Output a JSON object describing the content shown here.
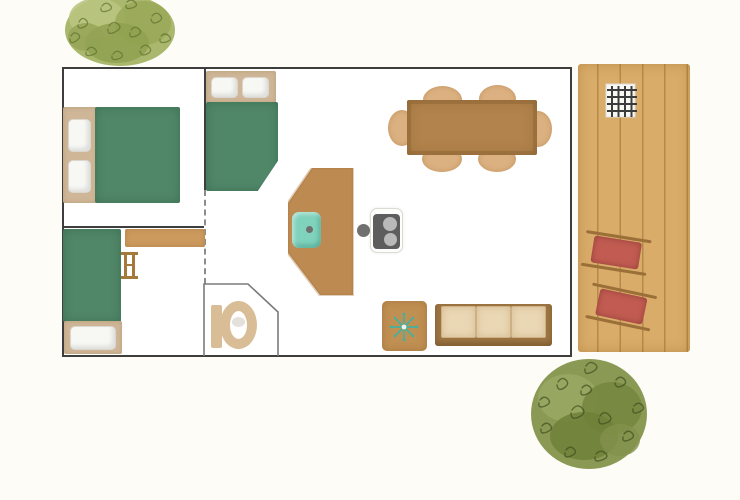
{
  "scene": {
    "type": "floor-plan",
    "style": "watercolor illustration, no text labels",
    "description": "Top-down floor plan of a small lodge: two bedrooms on the left, bathroom with toilet, open kitchen and dining-living area, wooden deck terrace on the right with barbecue and two sun loungers, decorative trees top-left and bottom-right"
  },
  "palette": {
    "background": "#fdfcf7",
    "wall": "#3e3e3e",
    "inner_wall": "#7b7b7b",
    "bed_green": "#518769",
    "headboard_tan": "#cfb697",
    "shelf_wood": "#cd9a5e",
    "wood_mid": "#bd8a52",
    "wood_dark": "#b2834c",
    "side_table_wood": "#c08f52",
    "chair_tan": "#dcb181",
    "deck_wood": "#d9ac69",
    "lounger_red": "#c25c52",
    "lounger_frame": "#9a7038",
    "sofa_frame": "#9d7543",
    "sofa_cushion": "#ead7b4",
    "sink_teal": "#7fd2bc",
    "stove_dark": "#5d5d5d",
    "burner_gray": "#b9b9b9",
    "toilet_tan": "#d8bd96",
    "snowflake_teal": "#45b0a0",
    "tree_light_green": "#a9b86c",
    "tree_dark_green": "#8a9a55"
  },
  "legend": {
    "house": "Lodge outline with walls",
    "bedroom_1": "Bedroom with double bed (2 pillows)",
    "bedroom_2": "Bedroom with single bed, shelf and ladder",
    "bed_double": "Double bed, green cover",
    "bed_small_double": "Small double bed against top wall",
    "bed_single": "Single bed, green cover",
    "shelf": "Wardrobe / shelf unit",
    "ladder": "Bunk ladder",
    "bathroom": "Bathroom with angled wall",
    "toilet": "Toilet",
    "kitchen_counter": "Angled kitchen counter",
    "sink": "Kitchen sink, teal",
    "hob": "Two-burner hob",
    "dining_table": "Dining table",
    "dining_chair": "Dining chair",
    "side_table": "Side table with snowflake motif",
    "sofa": "Three-seat sofa",
    "deck": "Wooden deck terrace",
    "barbecue": "Barbecue grill grate",
    "sun_lounger": "Red sun lounger",
    "tree": "Watercolor tree"
  },
  "counts": {
    "bedrooms": 2,
    "beds": 3,
    "pillows": 5,
    "dining_chairs": 6,
    "sofa_cushions": 3,
    "sun_loungers": 2,
    "deck_planks": 5,
    "hob_burners": 2,
    "trees": 2
  }
}
